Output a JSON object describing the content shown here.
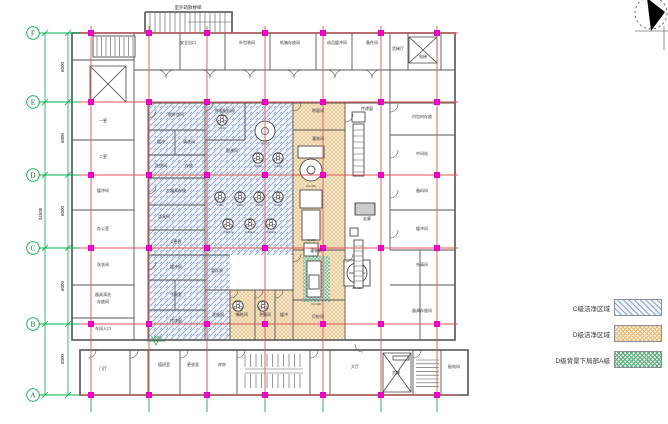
{
  "grid": {
    "row_labels": [
      "F",
      "E",
      "D",
      "C",
      "B",
      "A"
    ],
    "row_y": [
      33,
      102,
      175,
      248,
      324,
      395
    ],
    "col_x": [
      91,
      149,
      207,
      265,
      323,
      381,
      437
    ]
  },
  "dimensions": {
    "bays": [
      {
        "text": "6000",
        "y": 67
      },
      {
        "text": "6000",
        "y": 138
      },
      {
        "text": "6000",
        "y": 211
      },
      {
        "text": "6000",
        "y": 286
      },
      {
        "text": "6000",
        "y": 359
      }
    ],
    "total": {
      "text": "34500",
      "y": 214
    }
  },
  "annotations": {
    "exterior_stair_label": {
      "text": "室外疏散楼梯",
      "x": 188,
      "y": 9
    },
    "elevation_marker": {
      "text": "4.900",
      "x": 156,
      "y": 339
    }
  },
  "legend": {
    "items": [
      {
        "label": "C级洁净区域",
        "swatch": "blue-diagonal"
      },
      {
        "label": "D级洁净区域",
        "swatch": "orange-cross"
      },
      {
        "label": "D级背景下局部A级",
        "swatch": "green-cross"
      }
    ]
  },
  "rooms": [
    [
      "安全出口",
      188,
      44
    ],
    [
      "外包装间",
      247,
      44
    ],
    [
      "纸箱存放间",
      290,
      44
    ],
    [
      "成品缓冲间",
      337,
      44
    ],
    [
      "备件间",
      372,
      44
    ],
    [
      "货梯厅",
      398,
      50
    ],
    [
      "电梯",
      423,
      58
    ],
    [
      "一更",
      103,
      122
    ],
    [
      "二更",
      103,
      158
    ],
    [
      "缓冲间",
      103,
      192
    ],
    [
      "办公室",
      103,
      230
    ],
    [
      "洗衣间",
      103,
      266
    ],
    [
      "器具清洗",
      103,
      296
    ],
    [
      "存放间",
      103,
      303
    ],
    [
      "车间入口",
      103,
      330
    ],
    [
      "脱外包间",
      176,
      116
    ],
    [
      "缓冲",
      161,
      143
    ],
    [
      "清洗间",
      189,
      143
    ],
    [
      "洗烘间",
      161,
      167
    ],
    [
      "存放",
      189,
      167
    ],
    [
      "工器具存放",
      176,
      192
    ],
    [
      "洁具间",
      164,
      218
    ],
    [
      "C更衣",
      176,
      243
    ],
    [
      "缓冲间",
      176,
      268
    ],
    [
      "气闸室",
      176,
      296
    ],
    [
      "传递窗",
      176,
      322
    ],
    [
      "称量配料间",
      225,
      112
    ],
    [
      "配液间",
      232,
      152
    ],
    [
      "暂存间",
      217,
      272
    ],
    [
      "洗瓶间",
      218,
      316
    ],
    [
      "清洗间",
      242,
      316
    ],
    [
      "灭菌间",
      265,
      316
    ],
    [
      "缓冲",
      284,
      316
    ],
    [
      "称量间",
      318,
      112
    ],
    [
      "灌装间",
      318,
      140
    ],
    [
      "灌装机",
      316,
      252
    ],
    [
      "灯检间",
      318,
      318
    ],
    [
      "传递窗",
      367,
      110
    ],
    [
      "走廊",
      367,
      220
    ],
    [
      "内包材存放",
      422,
      118
    ],
    [
      "中间站",
      422,
      155
    ],
    [
      "备料间",
      422,
      192
    ],
    [
      "缓冲间",
      422,
      230
    ],
    [
      "外清间",
      422,
      266
    ],
    [
      "器具存放间",
      422,
      312
    ],
    [
      "门厅",
      103,
      370
    ],
    [
      "值班室",
      164,
      366
    ],
    [
      "更衣室",
      193,
      366
    ],
    [
      "库房",
      222,
      366
    ],
    [
      "大厅",
      355,
      368
    ],
    [
      "货梯",
      396,
      374
    ],
    [
      "配电间",
      454,
      368
    ]
  ],
  "tanks": [
    [
      222,
      120,
      "V-101",
      0
    ],
    [
      265,
      131,
      "R-301",
      1
    ],
    [
      258,
      158,
      "V-102",
      0
    ],
    [
      278,
      158,
      "V-103",
      0
    ],
    [
      220,
      197,
      "V-201",
      0
    ],
    [
      240,
      197,
      "V-202",
      0
    ],
    [
      259,
      197,
      "V-203",
      0
    ],
    [
      278,
      197,
      "V-204",
      0
    ],
    [
      228,
      224,
      "V-301-1",
      0
    ],
    [
      250,
      224,
      "V-301-2",
      0
    ],
    [
      271,
      224,
      "V-301-3",
      0
    ],
    [
      238,
      306,
      "XP-1",
      0
    ],
    [
      263,
      306,
      "XP-2",
      0
    ]
  ],
  "equipment_codes": [
    [
      311,
      187,
      "XG-300"
    ],
    [
      311,
      241,
      "YG-200"
    ],
    [
      357,
      289,
      "ZG-100"
    ],
    [
      316,
      305,
      "XC-100"
    ]
  ],
  "colors": {
    "grid_red": "#e05555",
    "grid_green": "#00b050",
    "node_magenta": "#ff00d4",
    "wall": "#555555",
    "hatch_blue": "#8ea3d2",
    "hatch_orange": "#e6b06a",
    "hatch_green": "#59a878"
  }
}
